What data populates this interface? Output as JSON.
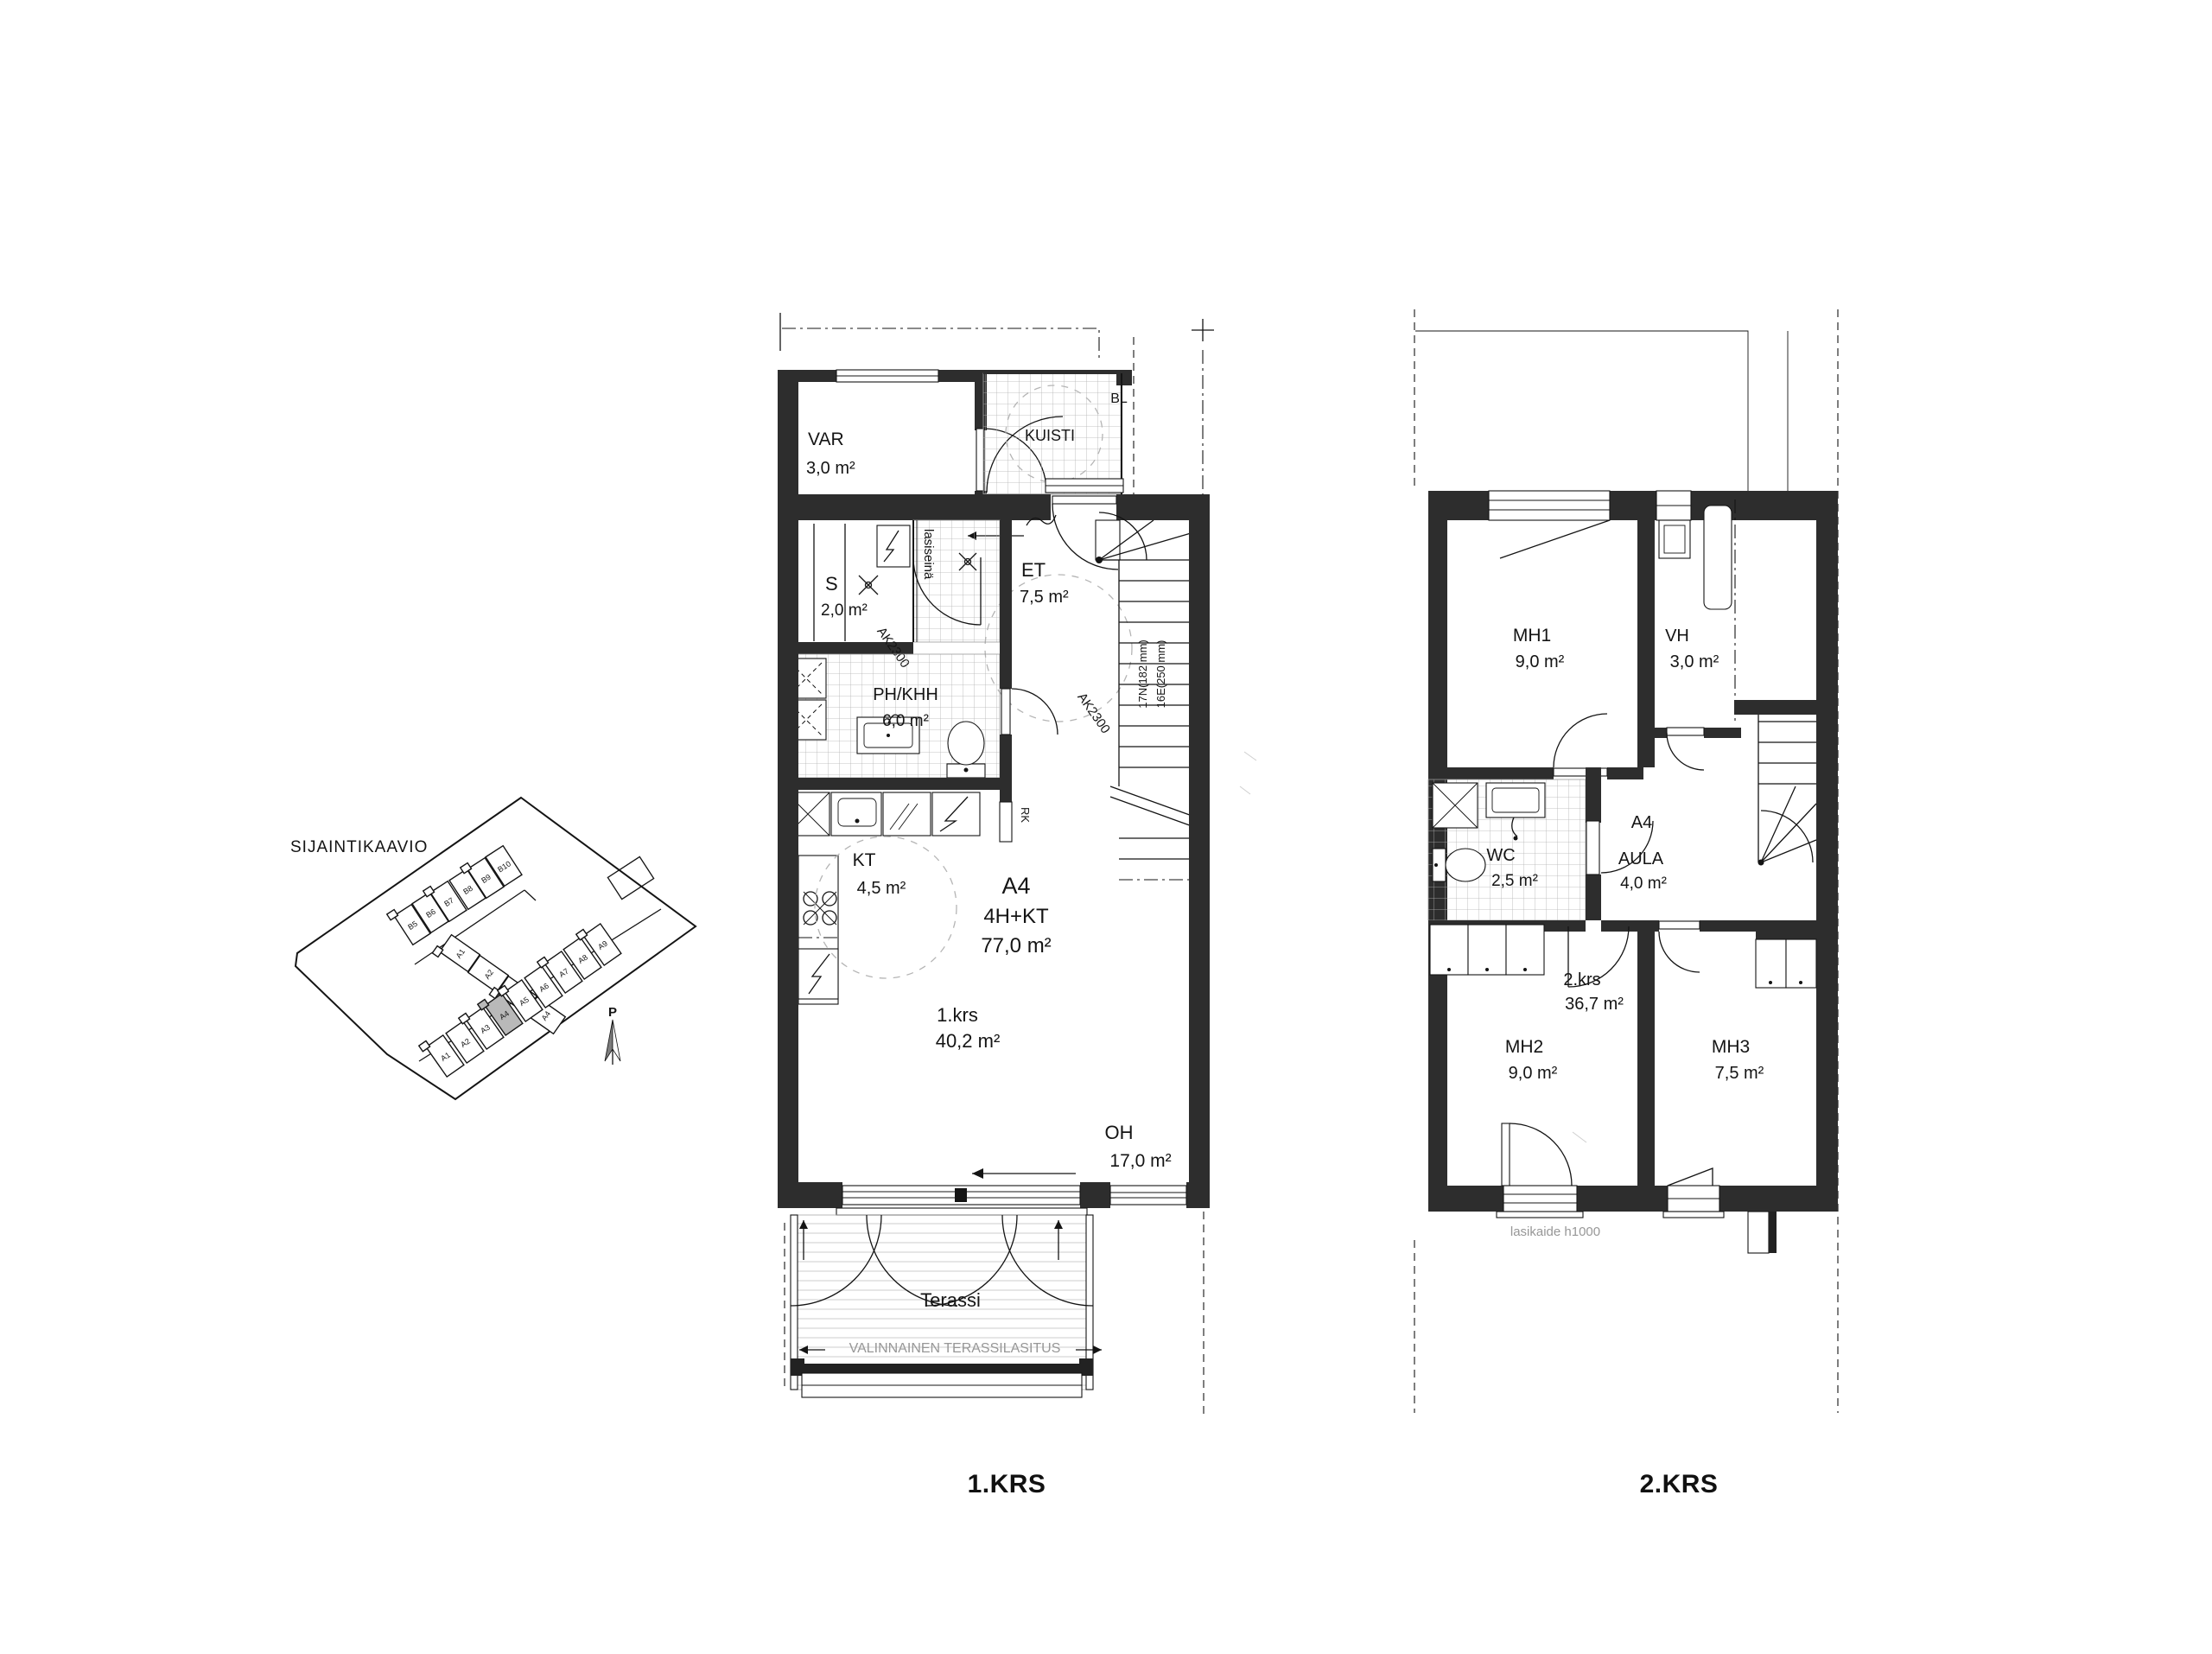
{
  "site": {
    "title": "SIJAINTIKAAVIO",
    "north_label": "P",
    "row_b_units": [
      "B5",
      "B6",
      "B7",
      "B8",
      "B9",
      "B10"
    ],
    "left_units": [
      "A1",
      "A2",
      "A3",
      "A4"
    ],
    "row_a_units": [
      "A1",
      "A2",
      "A3",
      "A4",
      "A5",
      "A6",
      "A7",
      "A8",
      "A9"
    ],
    "highlighted_unit": "A4"
  },
  "apartment": {
    "unit": "A4",
    "type": "4H+KT",
    "total_area": "77,0 m²"
  },
  "floor1": {
    "label": "1.KRS",
    "level": {
      "name": "1.krs",
      "area": "40,2 m²"
    },
    "rooms": {
      "var": {
        "name": "VAR",
        "area": "3,0 m²"
      },
      "kuisti": {
        "name": "KUISTI"
      },
      "s": {
        "name": "S",
        "area": "2,0 m²"
      },
      "et": {
        "name": "ET",
        "area": "7,5 m²"
      },
      "ph": {
        "name": "PH/KHH",
        "area": "6,0 m²"
      },
      "kt": {
        "name": "KT",
        "area": "4,5 m²"
      },
      "oh": {
        "name": "OH",
        "area": "17,0 m²"
      },
      "terassi": {
        "name": "Terassi"
      }
    },
    "annotations": {
      "bl": "BL",
      "glass_wall": "lasiseinä",
      "ak_sauna": "AK2300",
      "ak_et": "AK2300",
      "rk": "RK",
      "stair_risers": "17N(182 mm)",
      "stair_goings": "16E(250 mm)",
      "terrace_glazing": "VALINNAINEN TERASSILASITUS"
    }
  },
  "floor2": {
    "label": "2.KRS",
    "level": {
      "name": "2.krs",
      "area": "36,7 m²"
    },
    "unit_tag": "A4",
    "rooms": {
      "mh1": {
        "name": "MH1",
        "area": "9,0 m²"
      },
      "vh": {
        "name": "VH",
        "area": "3,0 m²"
      },
      "wc": {
        "name": "WC",
        "area": "2,5 m²"
      },
      "aula": {
        "name": "AULA",
        "area": "4,0 m²"
      },
      "mh2": {
        "name": "MH2",
        "area": "9,0 m²"
      },
      "mh3": {
        "name": "MH3",
        "area": "7,5 m²"
      }
    },
    "annotations": {
      "railing": "lasikaide h1000"
    }
  },
  "colors": {
    "wall": "#2d2d2d",
    "highlighted_unit": "#b9b9b9",
    "muted_text": "#979797"
  }
}
